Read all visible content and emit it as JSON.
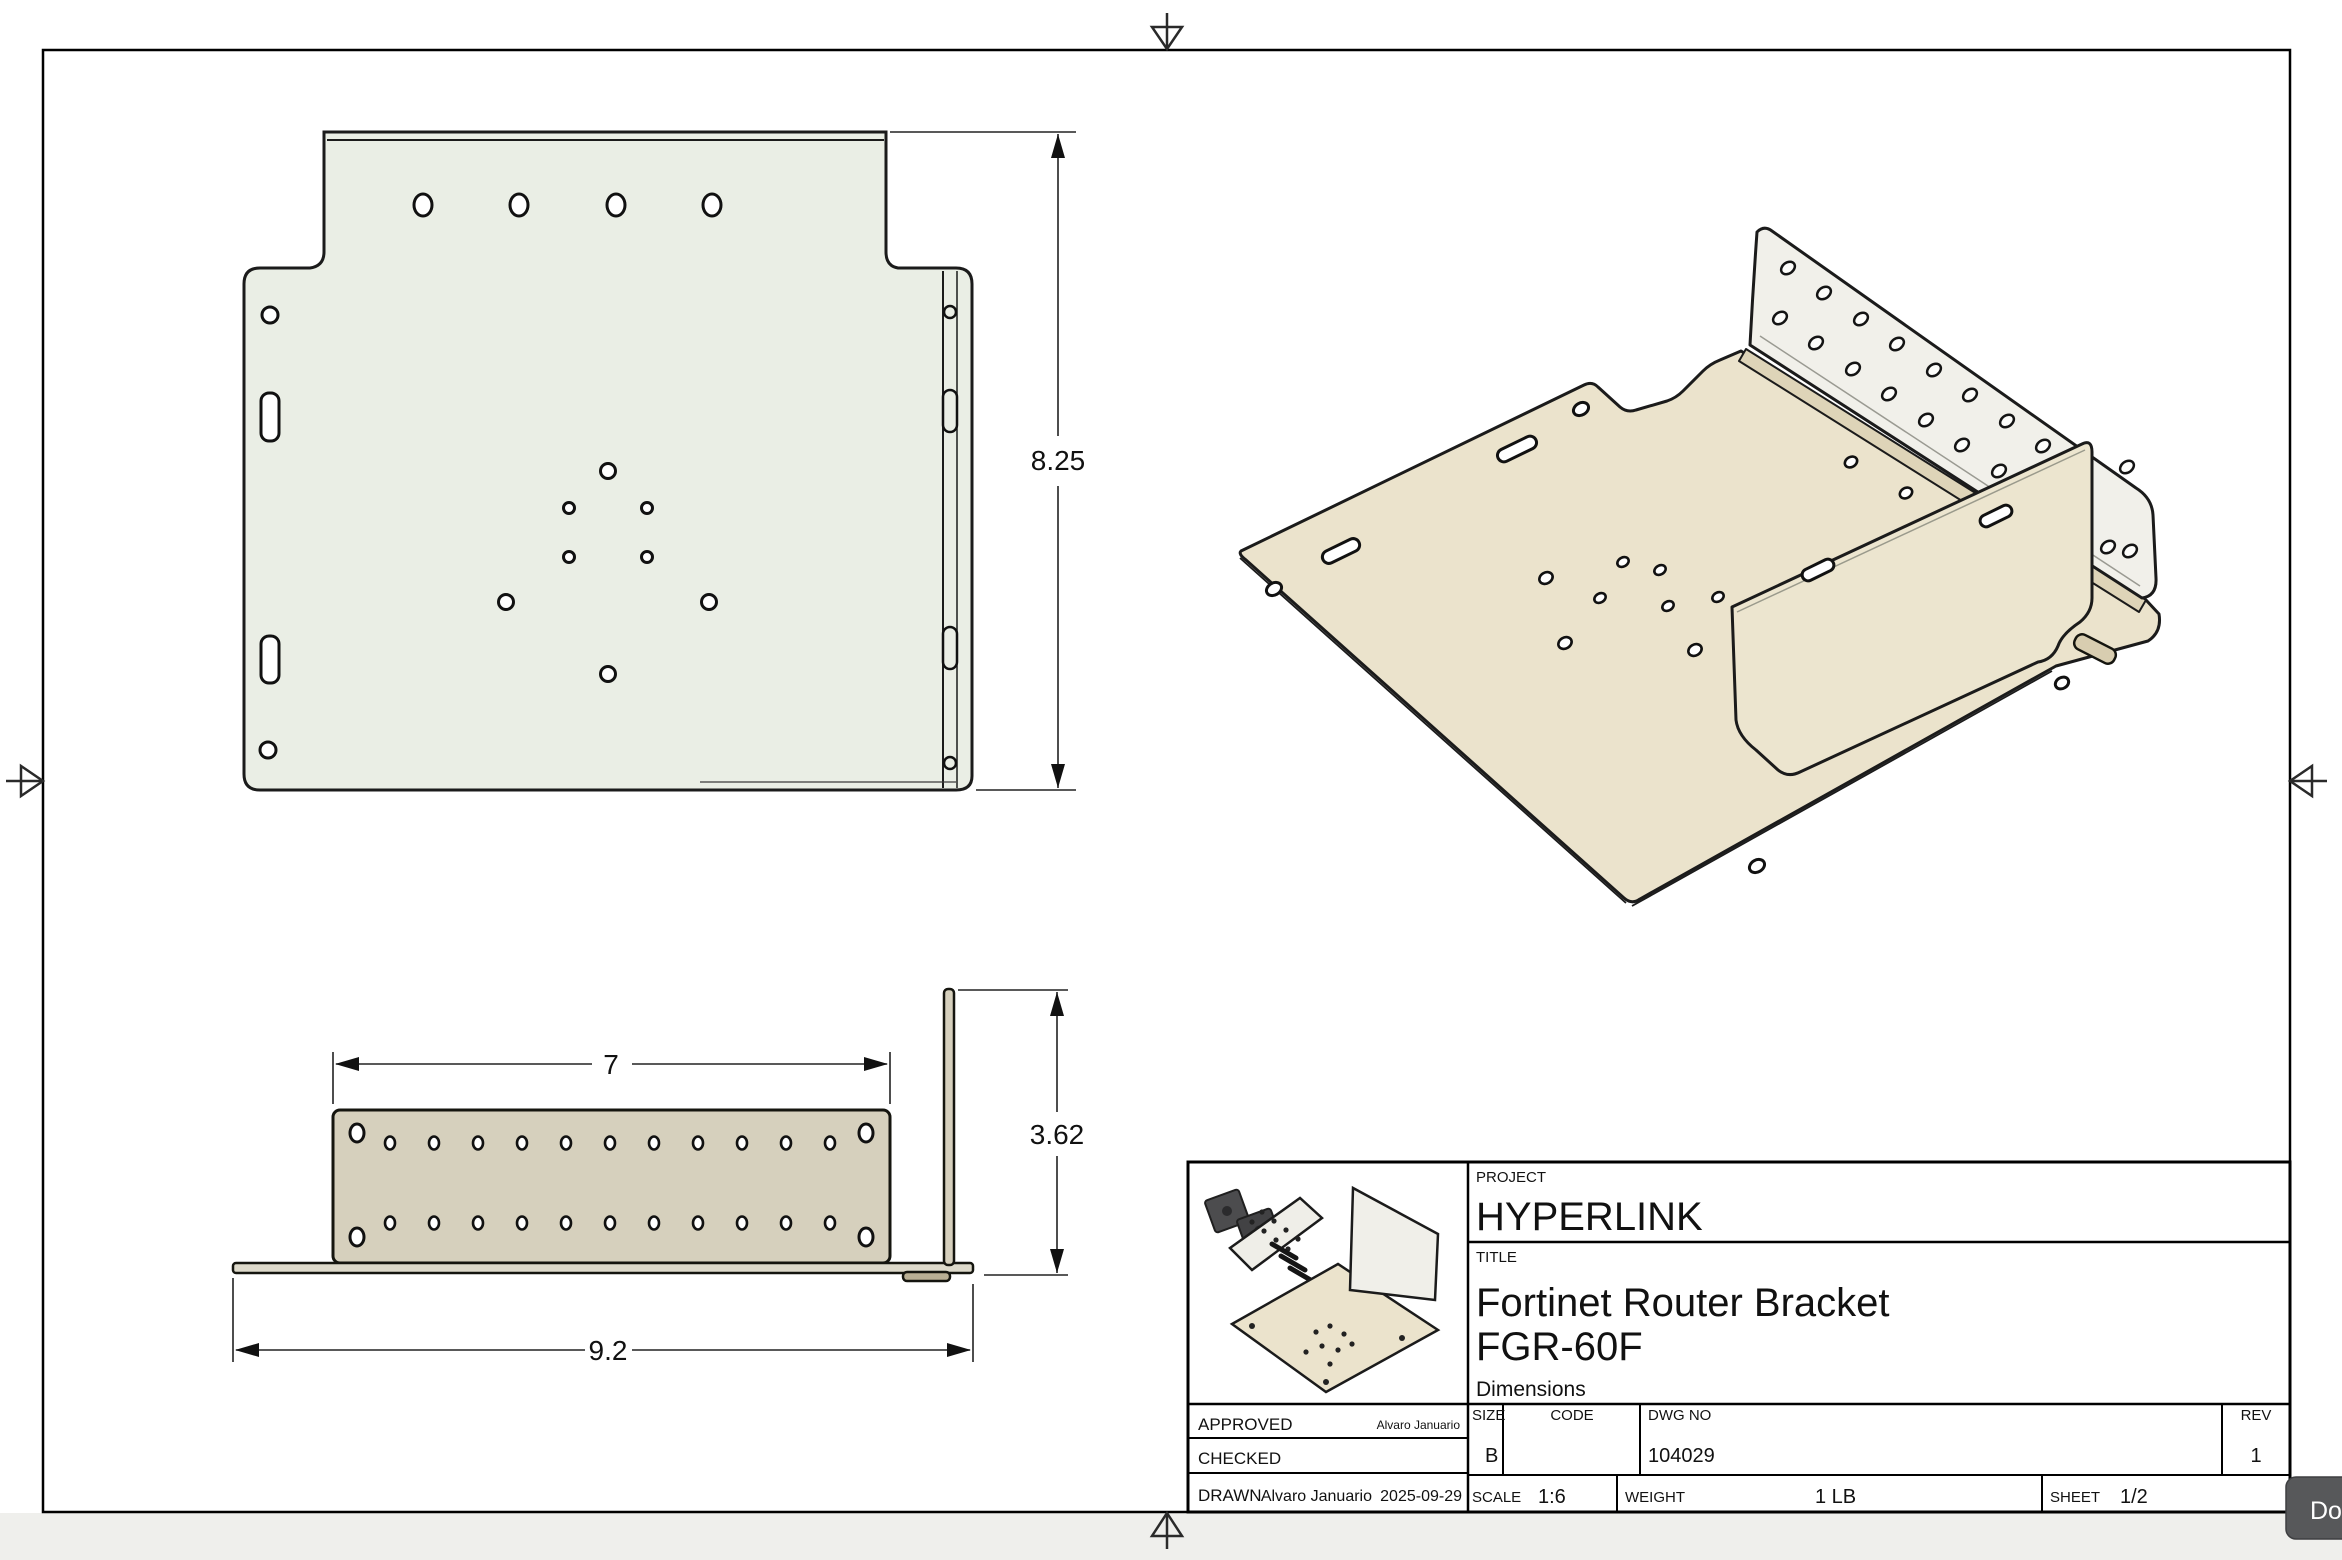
{
  "sheet": {
    "kind": "engineering-drawing-sheet",
    "centering_marks": [
      "top",
      "bottom",
      "left",
      "right"
    ]
  },
  "views": {
    "top": {
      "name": "top-view",
      "height_dim": "8.25"
    },
    "front": {
      "name": "front-view",
      "width_dim": "7",
      "height_dim": "3.62",
      "overall_width_dim": "9.2"
    },
    "isometric": {
      "name": "isometric-view"
    }
  },
  "title_block": {
    "project_label": "PROJECT",
    "project": "HYPERLINK",
    "title_label": "TITLE",
    "title_line1": "Fortinet Router Bracket",
    "title_line2": "FGR-60F",
    "title_line3": "Dimensions",
    "approved_label": "APPROVED",
    "approved_by": "Alvaro Januario",
    "checked_label": "CHECKED",
    "checked_by": "",
    "drawn_label": "DRAWN",
    "drawn_by": "Alvaro Januario",
    "drawn_date": "2025-09-29",
    "size_label": "SIZE",
    "size": "B",
    "code_label": "CODE",
    "code": "",
    "dwg_no_label": "DWG NO",
    "dwg_no": "104029",
    "rev_label": "REV",
    "rev": "1",
    "scale_label": "SCALE",
    "scale": "1:6",
    "weight_label": "WEIGHT",
    "weight": "1 LB",
    "sheet_label": "SHEET",
    "sheet": "1/2"
  },
  "overlay": {
    "download_label": "Do"
  },
  "colors": {
    "line": "#1a1a1a",
    "top_view_fill": "#eaeee5",
    "front_panel_fill": "#d6d0bd",
    "base_strip_fill": "#ddd9ca",
    "iso_tan": "#ebe3cc",
    "iso_flange_white": "#f1f0ea",
    "iso_bend": "#ded4b8",
    "button_bg": "#57585a",
    "outside_bottom_bar": "#efefec"
  }
}
